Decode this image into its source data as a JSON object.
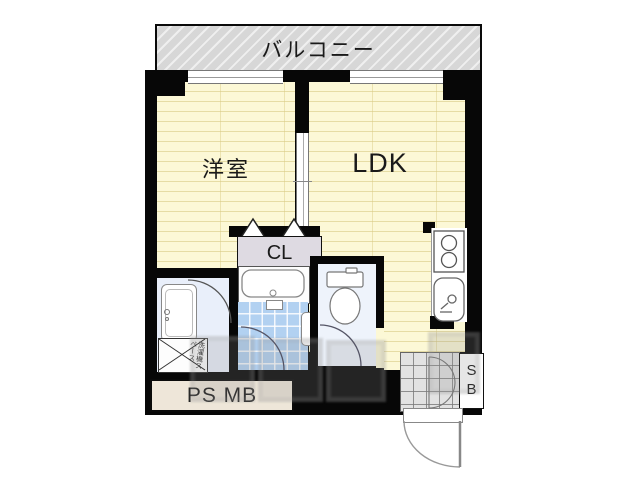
{
  "plan": {
    "type": "japanese-apartment-floor-plan",
    "balcony_label": "バルコニー",
    "rooms": {
      "western_room": "洋室",
      "ldk": "LDK",
      "closet": "CL"
    },
    "service": {
      "ps_mb": "PS MB",
      "shoe_box": "SB",
      "washer_space": "洗濯機スペース"
    },
    "fixtures": [
      "bathtub",
      "bathroom-tiled-floor",
      "toilet",
      "washbasin",
      "washing-machine-space",
      "kitchen-stove-2-burner",
      "kitchen-sink",
      "entrance-tiled-floor",
      "entry-door",
      "closet-folding-doors",
      "sliding-door",
      "windows"
    ],
    "colors": {
      "wall": "#070707",
      "room_floor": "#fcf8d6",
      "floor_stripe": "#d8c982",
      "balcony_fill": "#d7d7d7",
      "bath_tile": "#b2d1f1",
      "washroom_floor": "#e9effa",
      "toilet_floor": "#eef3fb",
      "closet_fill": "#dedae2",
      "ps_mb_fill": "#eee6d9",
      "entrance_tile": "#e2e2e2"
    }
  }
}
